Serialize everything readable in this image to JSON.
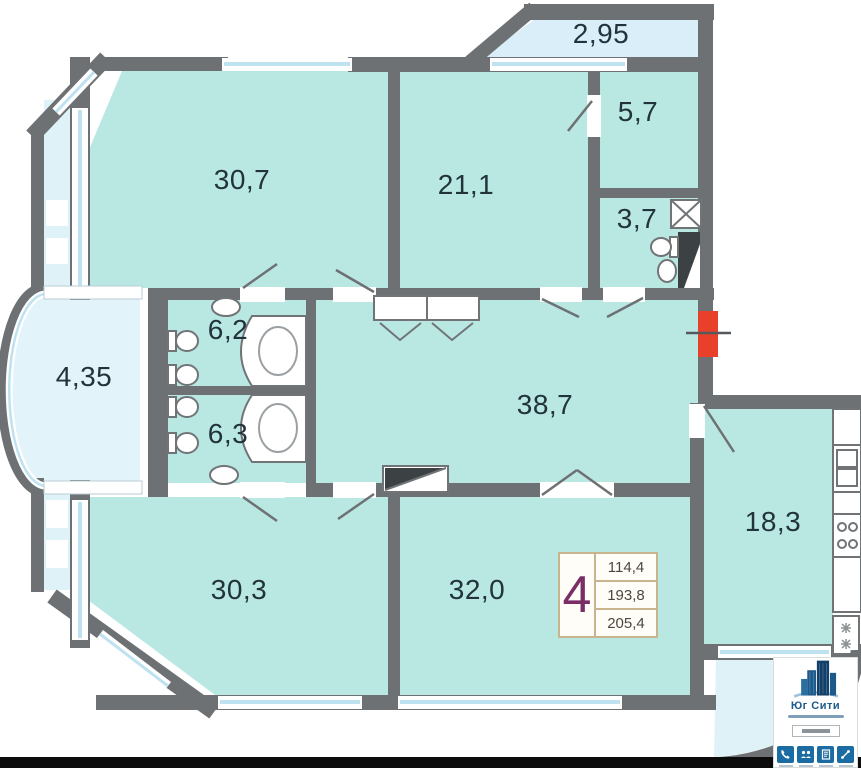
{
  "plan": {
    "type": "apartment-floor-plan",
    "rooms": [
      {
        "name": "bedroom-top-left",
        "area": "30,7"
      },
      {
        "name": "room-top-middle",
        "area": "21,1"
      },
      {
        "name": "dressing-top-right",
        "area": "5,7"
      },
      {
        "name": "bathroom-top-right",
        "area": "3,7"
      },
      {
        "name": "balcony-top",
        "area": "2,95"
      },
      {
        "name": "bay-balcony-left",
        "area": "4,35"
      },
      {
        "name": "bathroom-upper",
        "area": "6,2"
      },
      {
        "name": "bathroom-lower",
        "area": "6,3"
      },
      {
        "name": "hallway",
        "area": "38,7"
      },
      {
        "name": "kitchen",
        "area": "18,3"
      },
      {
        "name": "bedroom-bottom-left",
        "area": "30,3"
      },
      {
        "name": "room-bottom-middle",
        "area": "32,0"
      }
    ],
    "stamp": {
      "rooms_count": "4",
      "row1": "114,4",
      "row2": "193,8",
      "row3": "205,4"
    },
    "colors": {
      "room_fill": "#b9e8e3",
      "balcony_fill": "#dff2f8",
      "wall": "#6e7173",
      "entrance_marker": "#e8402a",
      "stamp_border": "#c9b48d",
      "stamp_number": "#7a2e66",
      "label_text": "#22333b",
      "logo_blue": "#1c5a8b"
    }
  },
  "logo": {
    "title": "Юг Сити"
  }
}
